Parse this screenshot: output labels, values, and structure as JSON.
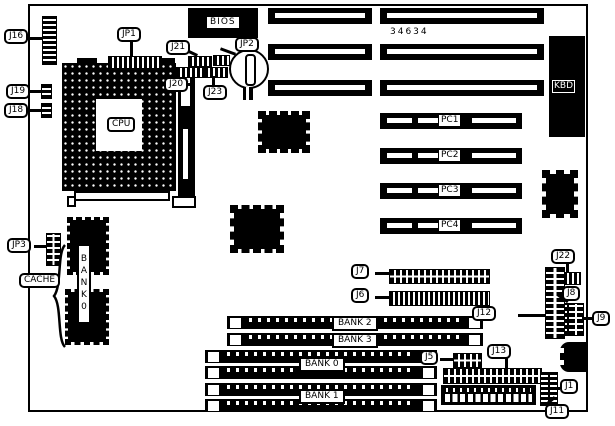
{
  "part_number": "34634",
  "callouts": {
    "j16": "J16",
    "jp1": "JP1",
    "j21": "J21",
    "jp2": "JP2",
    "j20": "J20",
    "j23": "J23",
    "j19": "J19",
    "j18": "J18",
    "jp3": "JP3",
    "cache": "CACHE",
    "j7": "J7",
    "j6": "J6",
    "j22": "J22",
    "j8": "J8",
    "j9": "J9",
    "j12": "J12",
    "j13": "J13",
    "j5": "J5",
    "j1": "J1",
    "j11": "J11"
  },
  "chips": {
    "cpu": "CPU",
    "bios": "BIOS",
    "kbd": "KBD",
    "vrm": "AV"
  },
  "memory": {
    "cache_bank_vertical": "BANK0",
    "simm_single": [
      {
        "label": "BANK 2"
      },
      {
        "label": "BANK 3"
      }
    ],
    "simm_pair": [
      {
        "label": "BANK 0"
      },
      {
        "label": "BANK 1"
      }
    ]
  },
  "pci_slots": [
    {
      "label": "PC1"
    },
    {
      "label": "PC2"
    },
    {
      "label": "PC3"
    },
    {
      "label": "PC4"
    }
  ]
}
